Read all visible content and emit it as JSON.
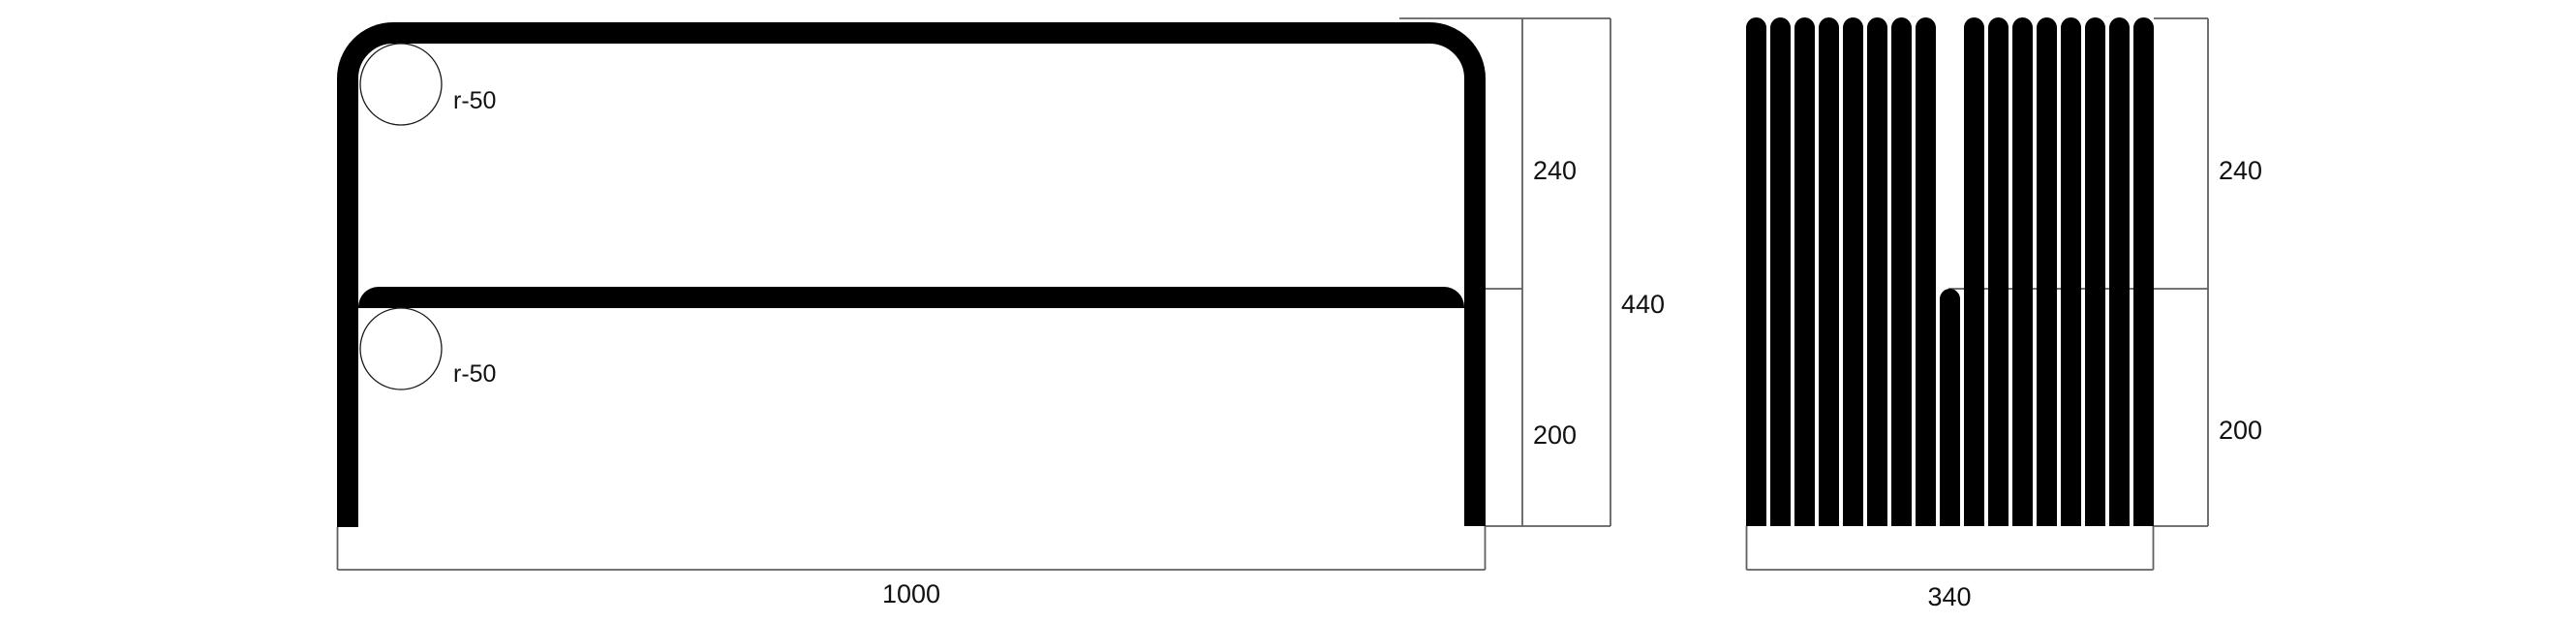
{
  "front_view": {
    "radius_label_top": "r-50",
    "radius_label_middle": "r-50",
    "dim_top_section": "240",
    "dim_bottom_section": "200",
    "dim_total_height": "440",
    "dim_overall_width": "1000"
  },
  "side_view": {
    "picket_count": 17,
    "short_picket_index": 8,
    "dim_top_section": "240",
    "dim_bottom_section": "200",
    "dim_overall_width": "340"
  },
  "colors": {
    "ink": "#000000",
    "dim_line": "#606060",
    "text": "#111111"
  }
}
